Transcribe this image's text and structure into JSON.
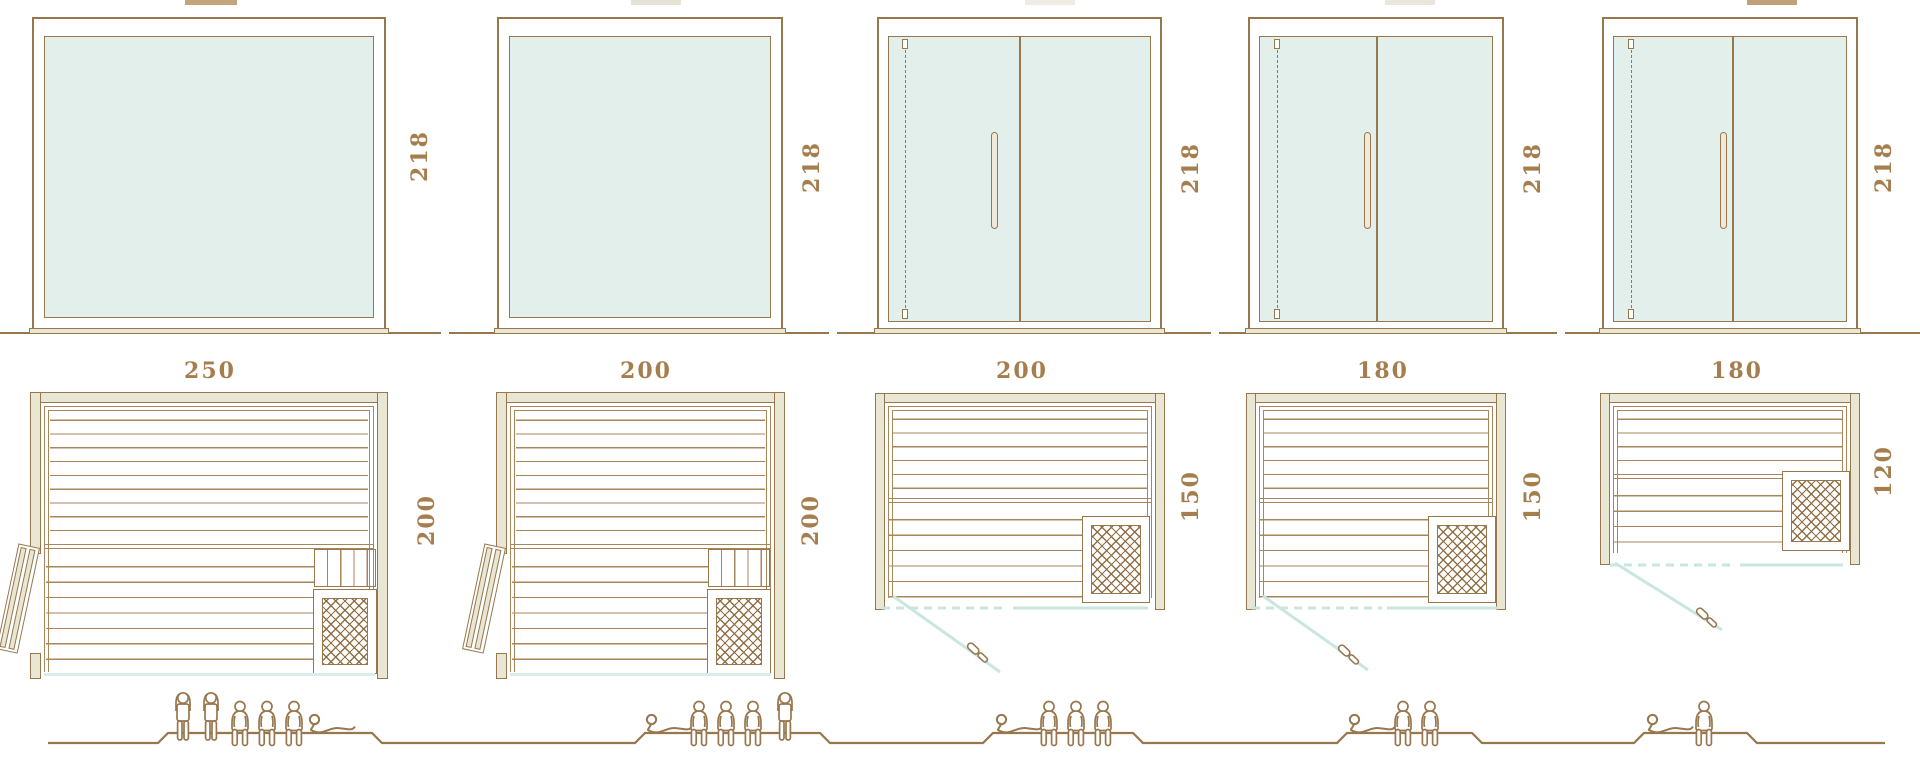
{
  "diagram": {
    "kind": "sauna size comparison diagram",
    "rows": [
      "front elevation",
      "floor plan",
      "capacity figures"
    ]
  },
  "colors": {
    "outline_brown": "#97774e",
    "bench_line_brown": "#a8865c",
    "wall_beige": "#e9e6d4",
    "glass_mint": "#e2efeb",
    "door_swing_teal": "#c9e6e1",
    "label_text_brown": "#a67e4d"
  },
  "units": [
    {
      "front": {
        "width": "250",
        "height": "218",
        "style": "fixed-glass-panel"
      },
      "plan": {
        "depth": "200",
        "door": "hinged-left-leaf",
        "heater": "bottom-right"
      },
      "capacity": {
        "standing": 2,
        "sitting": 3,
        "lying": 1
      },
      "people": [
        "standing",
        "standing",
        "sitting",
        "sitting",
        "sitting",
        "lying"
      ]
    },
    {
      "front": {
        "width": "200",
        "height": "218",
        "style": "fixed-glass-panel"
      },
      "plan": {
        "depth": "200",
        "door": "hinged-left-leaf",
        "heater": "bottom-right"
      },
      "capacity": {
        "standing": 1,
        "sitting": 3,
        "lying": 1
      },
      "people": [
        "lying",
        "sitting",
        "sitting",
        "sitting",
        "standing"
      ]
    },
    {
      "front": {
        "width": "200",
        "height": "218",
        "style": "double-glass-door"
      },
      "plan": {
        "depth": "150",
        "door": "glass-front-swing",
        "heater": "bottom-right"
      },
      "capacity": {
        "standing": 0,
        "sitting": 3,
        "lying": 1
      },
      "people": [
        "lying",
        "sitting",
        "sitting",
        "sitting"
      ]
    },
    {
      "front": {
        "width": "180",
        "height": "218",
        "style": "double-glass-door"
      },
      "plan": {
        "depth": "150",
        "door": "glass-front-swing",
        "heater": "bottom-right"
      },
      "capacity": {
        "standing": 0,
        "sitting": 2,
        "lying": 1
      },
      "people": [
        "lying",
        "sitting",
        "sitting"
      ]
    },
    {
      "front": {
        "width": "180",
        "height": "218",
        "style": "double-glass-door"
      },
      "plan": {
        "depth": "120",
        "door": "glass-front-swing",
        "heater": "bottom-right"
      },
      "capacity": {
        "standing": 0,
        "sitting": 1,
        "lying": 1
      },
      "people": [
        "lying",
        "sitting"
      ]
    }
  ]
}
